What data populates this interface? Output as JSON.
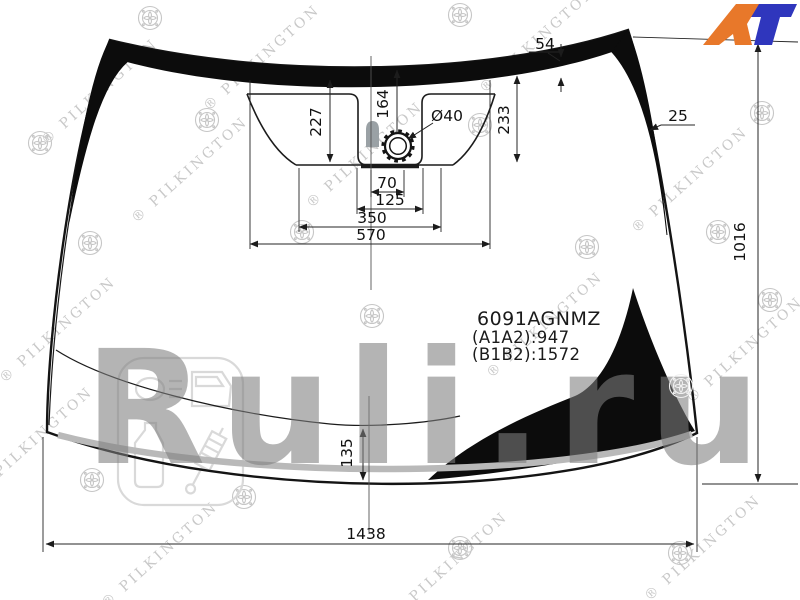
{
  "logo": {
    "a": "A",
    "t": "T",
    "orange": "#E8782A",
    "blue": "#2F36BD"
  },
  "part_info": {
    "number": "6091AGNMZ",
    "range_a": "(A1A2):947",
    "range_b": "(B1B2):1572"
  },
  "dims": {
    "top_band": "54",
    "side_band": "25",
    "left_drop": "227",
    "center_drop": "164",
    "right_drop": "233",
    "sensor_dia": "Ø40",
    "w70": "70",
    "w125": "125",
    "w350": "350",
    "w570": "570",
    "height": "1016",
    "bottom_band": "135",
    "width": "1438"
  },
  "watermarks": {
    "brand": "® PILKINGTON",
    "site": "Ruli.ru"
  },
  "colors": {
    "band_black": "#0c0c0c",
    "molding_gray": "#b9b9b9",
    "watermark_gray": "#c9c9c9"
  }
}
